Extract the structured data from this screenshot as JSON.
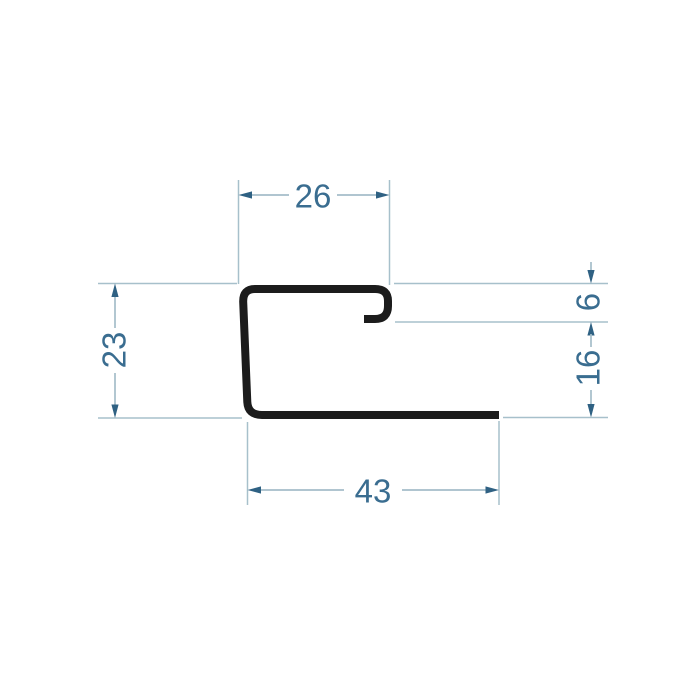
{
  "drawing": {
    "kind": "profile-cross-section-dimensional-drawing",
    "colors": {
      "profile": "#1c1c1c",
      "dimension_lines": "#a4bdc9",
      "arrows_and_text": "#3a6d90",
      "background": "#ffffff"
    },
    "dimensions": {
      "top_width": "26",
      "overall_height_left": "23",
      "hook_depth_right": "6",
      "lower_right_height": "16",
      "bottom_width": "43"
    }
  }
}
